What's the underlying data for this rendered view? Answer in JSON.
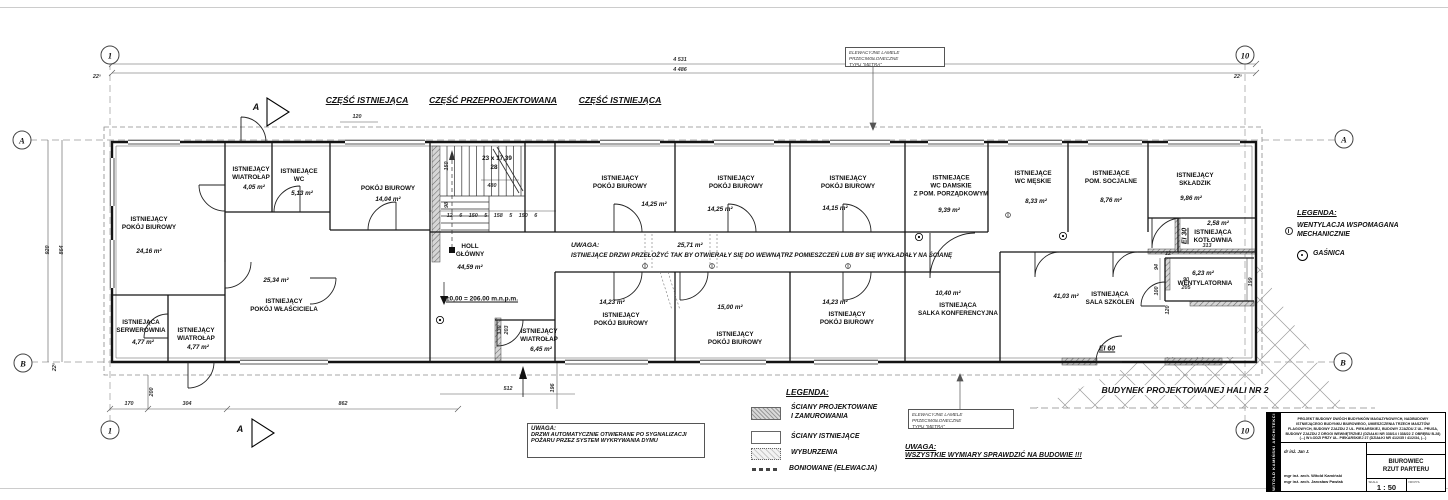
{
  "grid": {
    "col_start": "1",
    "col_end": "10",
    "row_a": "A",
    "row_b": "B",
    "section_marker": "A"
  },
  "headers": {
    "existing_left": "CZĘŚĆ ISTNIEJĄCA",
    "redesigned": "CZĘŚĆ PRZEPROJEKTOWANA",
    "existing_right": "CZĘŚĆ ISTNIEJĄCA"
  },
  "dims": {
    "top_outer": "4 531",
    "top_inner": "4 486",
    "top_left_wall": "22⁵",
    "top_right_wall": "22⁵",
    "seg_120": "120",
    "left_outer": "920",
    "left_inner": "864",
    "left_wall": "22⁵",
    "b_170": "170",
    "b_304": "304",
    "b_862": "862",
    "b_512": "512",
    "v_200": "200",
    "v_196": "196",
    "stair_run": "23 x 17,39",
    "stair_count": "28",
    "stair_480": "480",
    "stair_row": "12  6  150  5  158  5  150  6",
    "stair_150": "150",
    "stair_98": "98",
    "door_130": "130",
    "door_203": "203",
    "vent_313": "313",
    "vent_94": "94",
    "vent_100": "100",
    "vent_90": "90",
    "vent_205": "205",
    "vent_199": "199",
    "vent_120": "120",
    "vent_12": "12"
  },
  "level_note": "±0,00 = 206.00 m.n.p.m.",
  "fire": {
    "ei30": "EI 30",
    "ei60": "EI 60"
  },
  "rooms": [
    {
      "name": "ISTNIEJĄCY\nPOKÓJ BIUROWY",
      "area": "24,16 m²"
    },
    {
      "name": "ISTNIEJĄCY\nWIATROŁAP",
      "area": "4,05 m²"
    },
    {
      "name": "ISTNIEJĄCE\nWC",
      "area": "5,13 m²"
    },
    {
      "name": "POKÓJ BIUROWY",
      "area": "14,04 m²"
    },
    {
      "name": "HOLL\nGŁÓWNY",
      "area": "44,59 m²"
    },
    {
      "name": "ISTNIEJĄCY\nPOKÓJ WŁAŚCICIELA",
      "area": "25,34 m²"
    },
    {
      "name": "ISTNIEJĄCA\nSERWEROWNIA",
      "area": "4,77 m²"
    },
    {
      "name": "ISTNIEJĄCY\nWIATROŁAP",
      "area": "4,77 m²"
    },
    {
      "name": "ISTNIEJĄCY\nWIATROŁAP",
      "area": "6,45 m²"
    },
    {
      "name": "ISTNIEJĄCY\nPOKÓJ BIUROWY",
      "area": "14,25 m²"
    },
    {
      "name": "ISTNIEJĄCY\nPOKÓJ BIUROWY",
      "area": "14,25 m²"
    },
    {
      "name": "ISTNIEJĄCY\nPOKÓJ BIUROWY",
      "area": "14,15 m²"
    },
    {
      "name": "ISTNIEJĄCE\nWC DAMSKIE\nZ POM. PORZĄDKOWYM",
      "area": "9,39 m²"
    },
    {
      "name": "ISTNIEJĄCE\nWC MĘSKIE",
      "area": "8,33 m²"
    },
    {
      "name": "ISTNIEJĄCE\nPOM. SOCJALNE",
      "area": "8,76 m²"
    },
    {
      "name": "ISTNIEJĄCY\nSKŁADZIK",
      "area": "9,86 m²"
    },
    {
      "name": "ISTNIEJĄCA\nKOTŁOWNIA",
      "area": "2,58 m²"
    },
    {
      "name": "WENTYLATORNIA",
      "area": "6,23 m²"
    },
    {
      "name": "ISTNIEJĄCY\nPOKÓJ BIUROWY",
      "area": "14,23 m²"
    },
    {
      "name": "ISTNIEJĄCY\nPOKÓJ BIUROWY",
      "area": "15,00 m²"
    },
    {
      "name": "ISTNIEJĄCY\nPOKÓJ BIUROWY",
      "area": "14,23 m²"
    },
    {
      "name": "ISTNIEJĄCA\nSALKA KONFERENCYJNA",
      "area": "10,40 m²"
    },
    {
      "name": "ISTNIEJĄCA\nSALA SZKOLEŃ",
      "area": "41,03 m²"
    },
    {
      "name": "",
      "area": "25,71 m²"
    }
  ],
  "notes": {
    "doors_note_title": "UWAGA:",
    "doors_note_body": "ISTNIEJĄCE DRZWI PRZEŁOŻYĆ TAK BY OTWIERAŁY SIĘ DO WEWNĄTRZ POMIESZCZEŃ LUB BY SIĘ WYKŁADAŁY NA ŚCIANĘ",
    "auto_doors_title": "UWAGA:",
    "auto_doors_body": "DRZWI AUTOMATYCZNIE OTWIERANE PO SYGNALIZACJI\nPOŻARU PRZEZ SYSTEM WYKRYWANIA DYMU",
    "check_title": "UWAGA:",
    "check_body": "WSZYSTKIE WYMIARY SPRAWDZIĆ NA BUDOWIE !!!",
    "lamele": "ELEWACYJNE LAMELE PRZECIWSŁONECZNE\nTYPU \"METRA\"",
    "hala": "BUDYNEK PROJEKTOWANEJ HALI NR 2"
  },
  "legend_right": {
    "title": "LEGENDA:",
    "item_vent": "WENTYLACJA WSPOMAGANA\nMECHANICZNIE",
    "item_ext": "GAŚNICA"
  },
  "legend_bottom": {
    "title": "LEGENDA:",
    "item1": "ŚCIANY PROJEKTOWANE\nI ZAMUROWANIA",
    "item2": "ŚCIANY ISTNIEJĄCE",
    "item3": "WYBURZENIA",
    "item4": "BONIOWANE (ELEWACJA)"
  },
  "title_block": {
    "firm": "WITOLD KAMIŃSKI ARCHITEKCI",
    "project_title": "PROJEKT BUDOWY DWÓCH BUDYNKÓW MAGAZYNOWYCH, NADBUDOWY ISTNIEJĄCEGO BUDYNKU BIUROWEGO, UMIESZCZENIA TRZECH MASZTÓW FLAGOWYCH, BUDOWY ZJAZDU Z UL. PIEKARSKIEJ, BUDOWY ZJAZDU Z UL. PRUSA, BUDOWY ZJAZDU Z DROGI WEWNĘTRZNEJ (DZIAŁKI NR 338/14 I 338/22 Z OBRĘBU B-28) (...) W ŁODZI PRZY UL. PIEKARSKIEJ 27 (DZIAŁKI NR 41/2/35 I 41/2/34, (...)",
    "designer1": "dr inż. Jan J.",
    "designers": "mgr inż. arch. Witold Kamiński\nmgr inż. arch. Jarosław Pawlak",
    "drawing_title": "BIUROWIEC\nRZUT PARTERU",
    "scale_label": "SKALA",
    "scale": "1 : 50",
    "nr_label": "NR RYS."
  }
}
